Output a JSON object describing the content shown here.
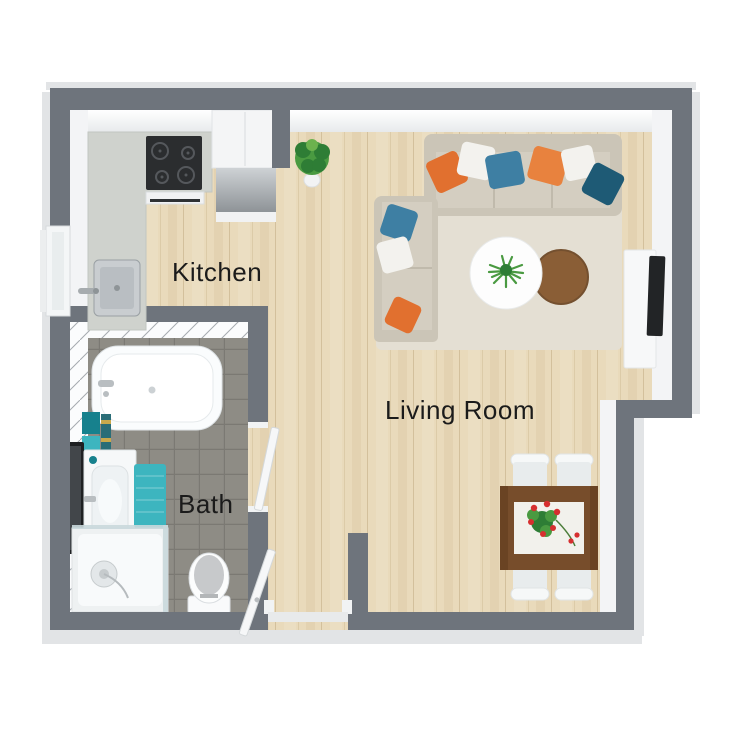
{
  "labels": {
    "kitchen": "Kitchen",
    "living_room": "Living Room",
    "bath": "Bath"
  },
  "rooms": [
    {
      "name": "Kitchen",
      "furniture": [
        "l-shaped-countertop",
        "cooktop",
        "oven-front",
        "kitchen-sink",
        "tall-cabinet",
        "appliance-unit",
        "window",
        "potted-plant"
      ]
    },
    {
      "name": "Living Room",
      "furniture": [
        "corner-sofa",
        "throw-pillows",
        "area-rug",
        "round-coffee-table-white",
        "round-coffee-table-wood",
        "table-plant",
        "tv-stand",
        "tv",
        "dining-table",
        "table-runner",
        "flower-centerpiece",
        "dining-chairs"
      ]
    },
    {
      "name": "Bath",
      "furniture": [
        "bathtub",
        "walk-in-shower",
        "toilet",
        "vanity-sink",
        "wall-mirror",
        "towels",
        "bath-mat"
      ]
    }
  ],
  "pillow_colors": [
    "#e1702f",
    "#f3f2ee",
    "#3e7fa3",
    "#e8823e",
    "#1e5a75"
  ],
  "colors": {
    "bg": "#ffffff",
    "wall": "#6e747c",
    "wall-inner": "#f3f4f6",
    "wall-base": "#e2e4e6",
    "floor-wood": "#e9dabb",
    "floor-wood-line": "#d3c09c",
    "floor-tile": "#8e8c85",
    "floor-tile-line": "#7b7973",
    "tile-wall": "#fbfcfd",
    "tile-seam": "#a6abb0",
    "rug": "#e4dfd3",
    "sofa": "#cbc5b7",
    "sofa-seat": "#d4cec1",
    "pillow-orange": "#e1702f",
    "pillow-orange2": "#e8823e",
    "pillow-white": "#f3f2ee",
    "pillow-steel": "#3e7fa3",
    "pillow-teal": "#1e5a75",
    "teal": "#3db5bf",
    "teal-dark": "#17818d",
    "counter": "#cfd2cd",
    "cooktop": "#2b2d2f",
    "table-wood": "#8a5e36",
    "table-dining": "#774d2b",
    "runner": "#f2f1ec",
    "plant": "#4a9a41",
    "plant-dark": "#2e7d35",
    "flower": "#d62f2f",
    "tv": "#222426",
    "mirror": "#1e2022",
    "door": "#f6f7f8",
    "glass": "#c9d8dc",
    "ink": "#1b1b1b"
  }
}
